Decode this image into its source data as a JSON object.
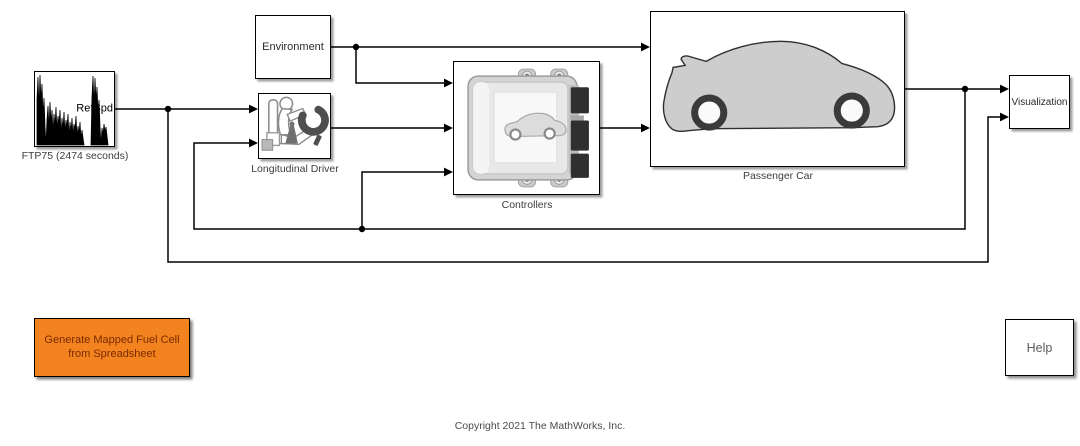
{
  "blocks": {
    "ftp75": {
      "port_label": "RefSpd",
      "caption": "FTP75 (2474  seconds)"
    },
    "environment": {
      "title": "Environment"
    },
    "longitudinal_driver": {
      "caption": "Longitudinal Driver"
    },
    "controllers": {
      "caption": "Controllers"
    },
    "passenger_car": {
      "caption": "Passenger Car"
    },
    "visualization": {
      "title": "Visualization"
    }
  },
  "buttons": {
    "generate": {
      "line1": "Generate Mapped Fuel Cell",
      "line2": "from Spreadsheet",
      "background": "#f3831e",
      "text_color": "#7a2a00"
    },
    "help": {
      "label": "Help"
    }
  },
  "footer": {
    "copyright": "Copyright 2021 The MathWorks, Inc."
  },
  "colors": {
    "wire": "#000000",
    "block_border": "#000000",
    "caption_text": "#3d3d3d",
    "help_text": "#5a5a5a"
  }
}
